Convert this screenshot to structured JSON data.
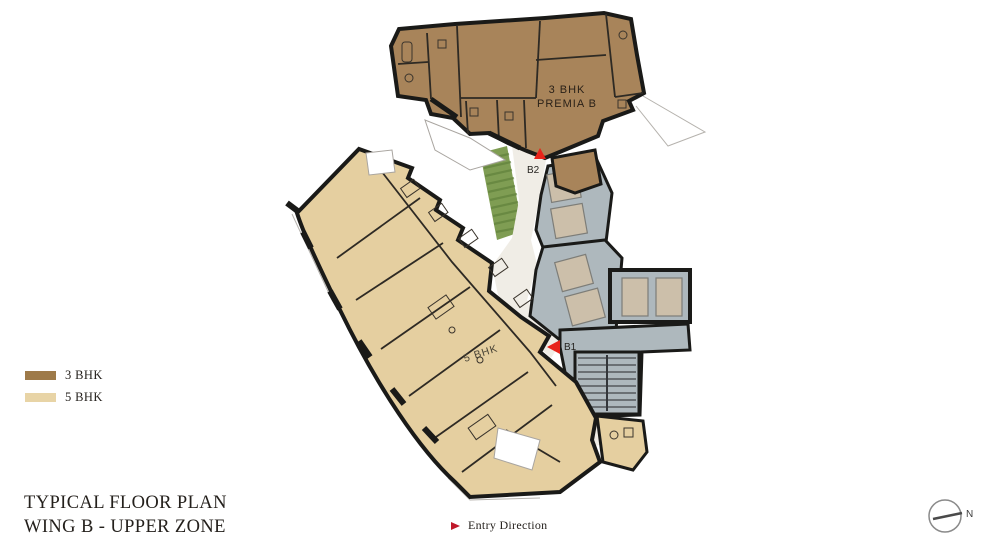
{
  "title": {
    "line1": "TYPICAL FLOOR PLAN",
    "line2": "WING B - UPPER ZONE"
  },
  "legend": {
    "items": [
      {
        "label": "3 BHK",
        "color": "#9E7A49"
      },
      {
        "label": "5 BHK",
        "color": "#E8D4A6"
      }
    ]
  },
  "plan": {
    "labels": {
      "premia_line1": "3 BHK",
      "premia_line2": "PREMIA  B",
      "five_bhk": "5 BHK"
    },
    "entries": {
      "b1": "B1",
      "b2": "B2"
    },
    "colors": {
      "wing_3bhk": "#A8845A",
      "wing_5bhk": "#E5CFA0",
      "core_gray": "#AEB8BD",
      "lift_car": "#CCBFAA",
      "corridor": "#F0EDE6",
      "planter_green": "#7F9D53",
      "planter_stripe": "#5E7F39",
      "entry_marker_red": "#E8231A",
      "wall_black": "#1A1A18"
    }
  },
  "footer": {
    "entry_direction": "Entry Direction"
  },
  "compass": {
    "north_label": "N"
  }
}
